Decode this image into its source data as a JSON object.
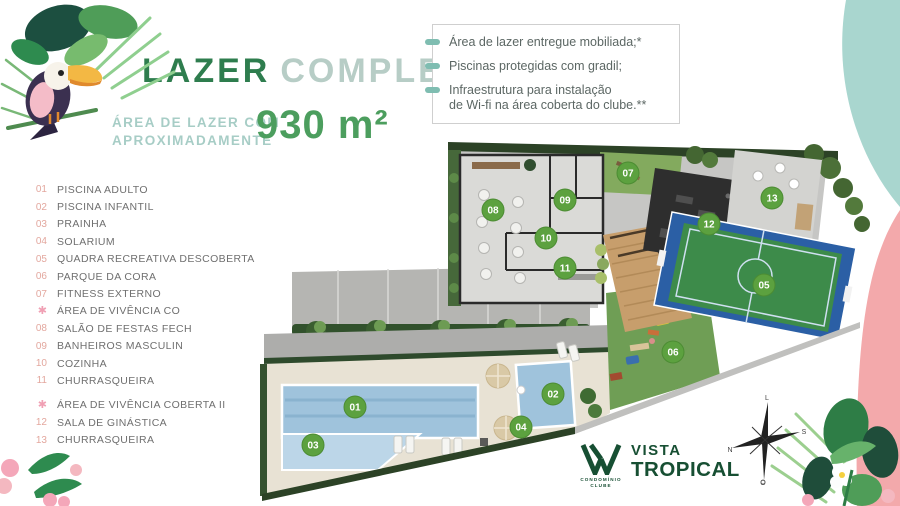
{
  "header": {
    "title_primary": "LAZER",
    "title_secondary": "COMPLETO",
    "subtitle_line1": "ÁREA DE LAZER COM",
    "subtitle_line2": "APROXIMADAMENTE",
    "area_value": "930 m²"
  },
  "features": {
    "items": [
      {
        "lines": [
          "Área de lazer entregue mobiliada;*"
        ]
      },
      {
        "lines": [
          "Piscinas protegidas com gradil;"
        ]
      },
      {
        "lines": [
          "Infraestrutura para instalação",
          "de Wi-fi na área coberta do clube.**"
        ]
      }
    ]
  },
  "legend": {
    "items": [
      {
        "num": "01",
        "label": "PISCINA ADULTO"
      },
      {
        "num": "02",
        "label": "PISCINA INFANTIL"
      },
      {
        "num": "03",
        "label": "PRAINHA"
      },
      {
        "num": "04",
        "label": "SOLARIUM"
      },
      {
        "num": "05",
        "label": "QUADRA RECREATIVA DESCOBERTA"
      },
      {
        "num": "06",
        "label": "PARQUE DA CORA"
      },
      {
        "num": "07",
        "label": "FITNESS EXTERNO"
      },
      {
        "icon": "flower",
        "label": "ÁREA DE VIVÊNCIA CO"
      },
      {
        "num": "08",
        "label": "SALÃO DE FESTAS FECH"
      },
      {
        "num": "09",
        "label": "BANHEIROS MASCULIN"
      },
      {
        "num": "10",
        "label": "COZINHA"
      },
      {
        "num": "11",
        "label": "CHURRASQUEIRA"
      },
      {
        "icon": "flower",
        "label": "ÁREA DE VIVÊNCIA COBERTA II",
        "gap": true
      },
      {
        "num": "12",
        "label": "SALA DE GINÁSTICA"
      },
      {
        "num": "13",
        "label": "CHURRASQUEIRA"
      }
    ],
    "flower_glyph": "✱"
  },
  "plan": {
    "markers": [
      {
        "num": "01",
        "x": 97,
        "y": 269
      },
      {
        "num": "02",
        "x": 295,
        "y": 256
      },
      {
        "num": "03",
        "x": 55,
        "y": 307
      },
      {
        "num": "04",
        "x": 263,
        "y": 289
      },
      {
        "num": "05",
        "x": 506,
        "y": 147
      },
      {
        "num": "06",
        "x": 415,
        "y": 214
      },
      {
        "num": "07",
        "x": 370,
        "y": 35
      },
      {
        "num": "08",
        "x": 235,
        "y": 72
      },
      {
        "num": "09",
        "x": 307,
        "y": 62
      },
      {
        "num": "10",
        "x": 288,
        "y": 100
      },
      {
        "num": "11",
        "x": 307,
        "y": 130
      },
      {
        "num": "12",
        "x": 451,
        "y": 86
      },
      {
        "num": "13",
        "x": 514,
        "y": 60
      }
    ]
  },
  "compass": {
    "top": "L",
    "right": "S",
    "bottom": "O",
    "left": "N"
  },
  "logo": {
    "name_line1": "VISTA",
    "name_line2": "TROPICAL",
    "tagline_line1": "CONDOMÍNIO",
    "tagline_line2": "CLUBE"
  },
  "colors": {
    "title_green": "#2e7d4e",
    "title_light": "#b7cdc6",
    "subtitle_teal": "#a7cdc6",
    "area_green": "#4c9e5e",
    "bullet_teal": "#7fbdb1",
    "legend_number_salmon": "#e3a79e",
    "legend_flower_pink": "#f0a0b4",
    "marker_green": "#5ca13f",
    "blob_teal": "#a9d6cf",
    "blob_pink": "#f3a9ab",
    "logo_green": "#174f33"
  }
}
